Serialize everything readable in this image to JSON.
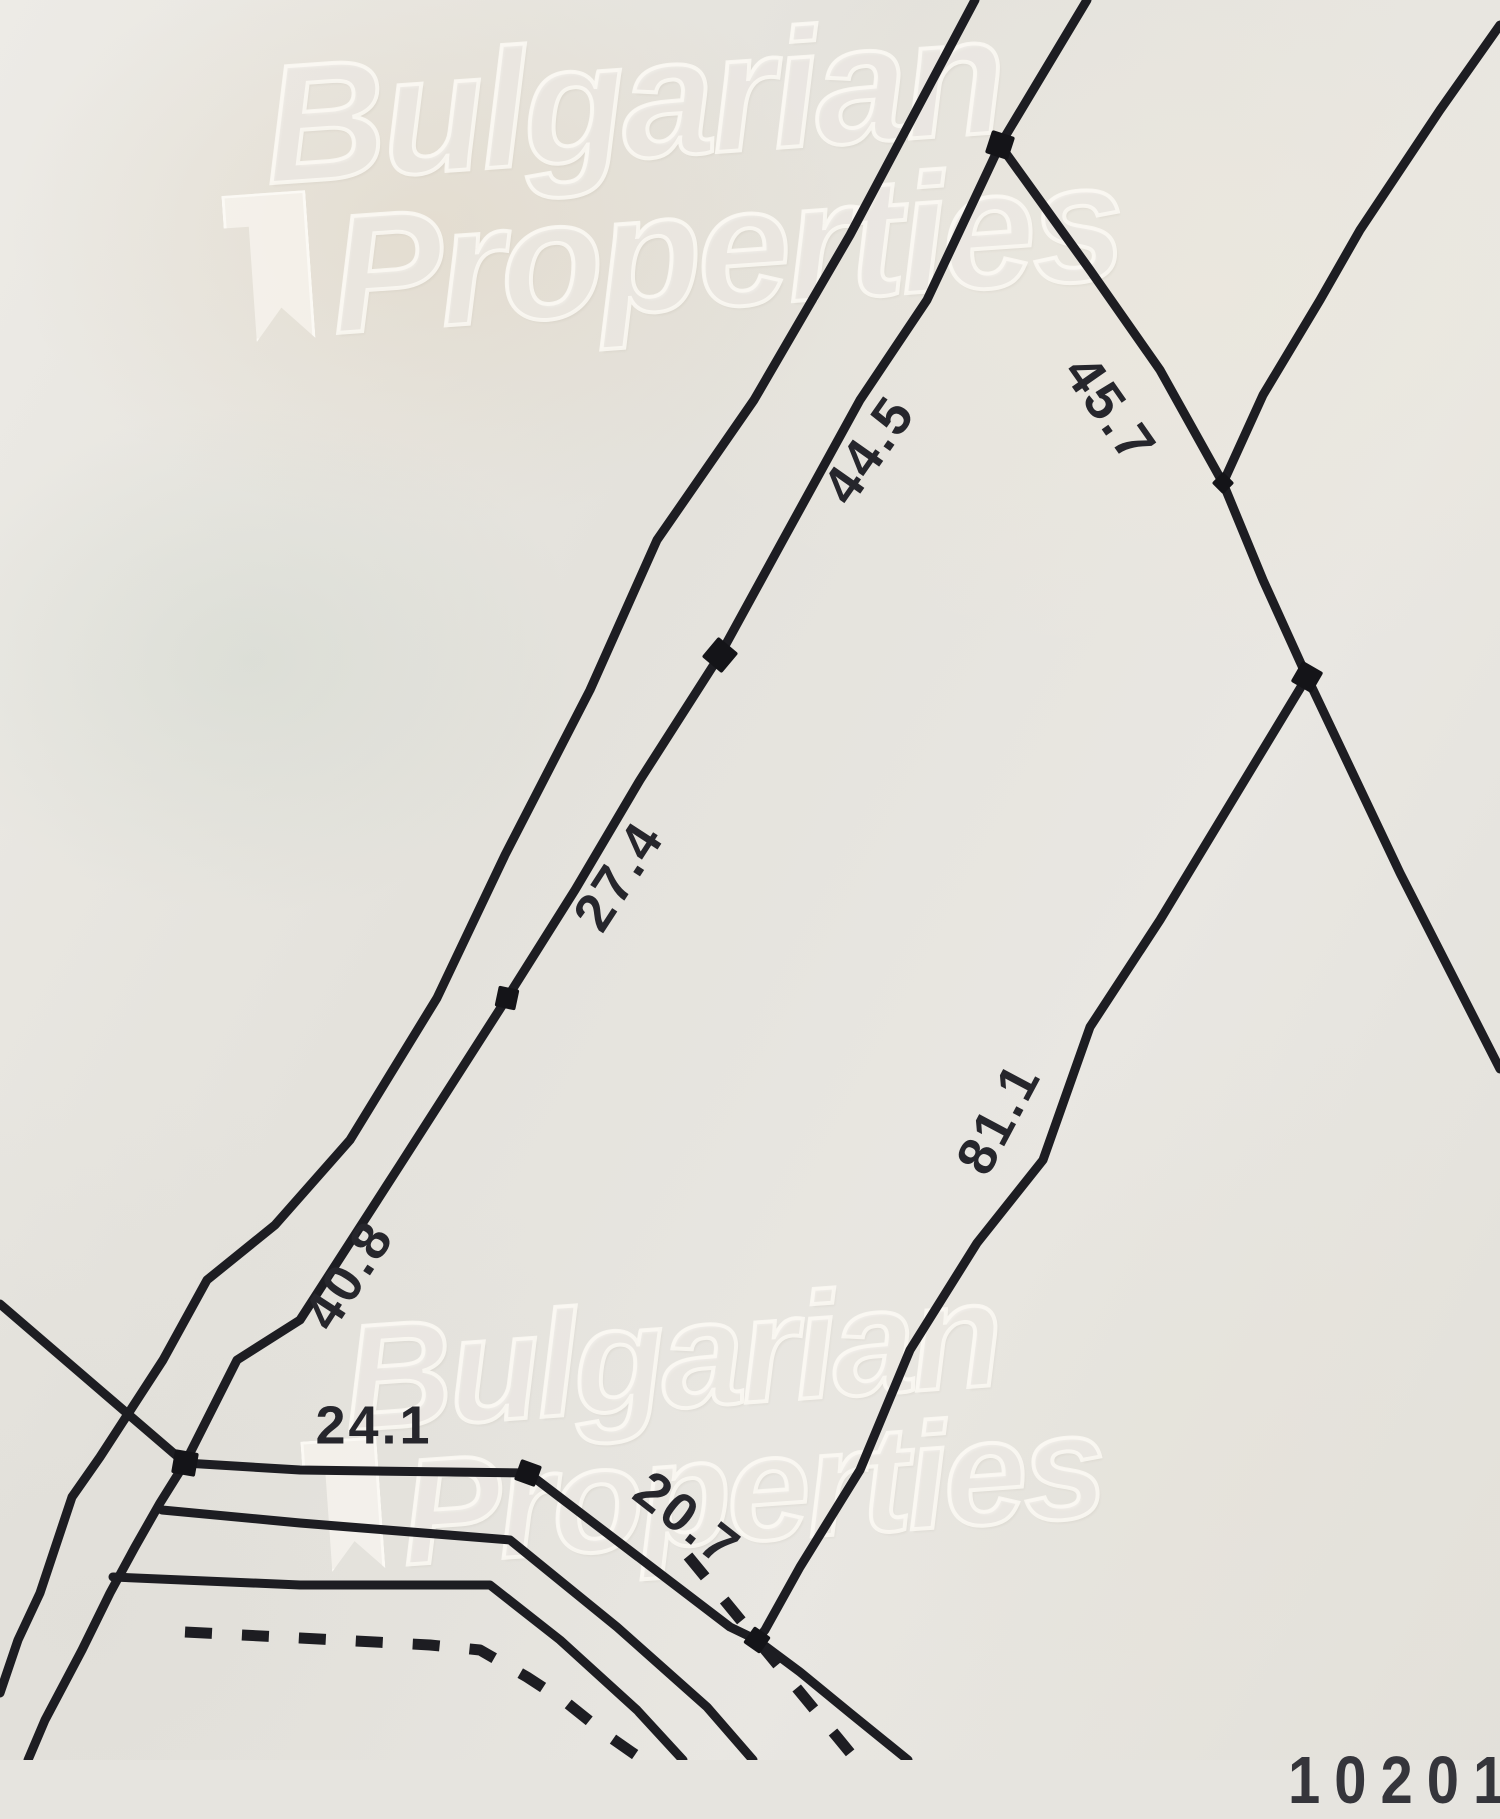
{
  "watermark": {
    "line1": "Bulgarian",
    "line2": "Properties"
  },
  "plan_number": "102015",
  "colors": {
    "paper": "#e6e4df",
    "line": "#1d1d22",
    "label": "#26262c",
    "node": "#141418",
    "watermark_stroke": "rgba(250,248,242,0.88)"
  },
  "drawing": {
    "width": 1500,
    "height": 1760,
    "stroke_width": 9,
    "dash_pattern": "27 30",
    "label_font_size": 54,
    "labels": [
      {
        "name": "dimension-44-5",
        "text": "44.5",
        "x": 872,
        "y": 452,
        "rot": -55
      },
      {
        "name": "dimension-45-7",
        "text": "45.7",
        "x": 1107,
        "y": 412,
        "rot": 55
      },
      {
        "name": "dimension-27-4",
        "text": "27.4",
        "x": 622,
        "y": 878,
        "rot": -57
      },
      {
        "name": "dimension-40-8",
        "text": "40.8",
        "x": 352,
        "y": 1277,
        "rot": -57
      },
      {
        "name": "dimension-81-1",
        "text": "81.1",
        "x": 1002,
        "y": 1120,
        "rot": -62
      },
      {
        "name": "dimension-24-1",
        "text": "24.1",
        "x": 374,
        "y": 1429,
        "rot": 0
      },
      {
        "name": "dimension-20-7",
        "text": "20.7",
        "x": 685,
        "y": 1522,
        "rot": 38
      }
    ],
    "polylines": [
      {
        "name": "left-road-boundary",
        "points": [
          [
            975,
            0
          ],
          [
            850,
            235
          ],
          [
            754,
            400
          ],
          [
            657,
            540
          ],
          [
            590,
            690
          ],
          [
            505,
            855
          ],
          [
            437,
            998
          ],
          [
            350,
            1140
          ],
          [
            275,
            1225
          ],
          [
            207,
            1280
          ],
          [
            163,
            1360
          ],
          [
            100,
            1457
          ],
          [
            72,
            1497
          ],
          [
            40,
            1593
          ],
          [
            18,
            1640
          ],
          [
            0,
            1693
          ]
        ]
      },
      {
        "name": "main-parcel-boundary",
        "points": [
          [
            1087,
            0
          ],
          [
            1000,
            145
          ],
          [
            927,
            300
          ],
          [
            860,
            400
          ],
          [
            783,
            540
          ],
          [
            720,
            655
          ],
          [
            640,
            780
          ],
          [
            575,
            890
          ],
          [
            507,
            998
          ],
          [
            400,
            1165
          ],
          [
            300,
            1320
          ],
          [
            237,
            1360
          ],
          [
            185,
            1463
          ],
          [
            160,
            1503
          ],
          [
            135,
            1547
          ],
          [
            110,
            1593
          ],
          [
            82,
            1650
          ],
          [
            45,
            1720
          ],
          [
            28,
            1760
          ]
        ]
      },
      {
        "name": "segment-45-7",
        "points": [
          [
            1000,
            145
          ],
          [
            1090,
            270
          ],
          [
            1160,
            370
          ],
          [
            1223,
            483
          ]
        ]
      },
      {
        "name": "top-right-boundary",
        "points": [
          [
            1500,
            25
          ],
          [
            1440,
            110
          ],
          [
            1360,
            230
          ],
          [
            1320,
            300
          ],
          [
            1263,
            395
          ],
          [
            1223,
            483
          ]
        ]
      },
      {
        "name": "segment-c-to-b",
        "points": [
          [
            1223,
            483
          ],
          [
            1263,
            580
          ],
          [
            1307,
            677
          ]
        ]
      },
      {
        "name": "east-boundary-continuation",
        "points": [
          [
            1307,
            677
          ],
          [
            1400,
            873
          ],
          [
            1500,
            1069
          ]
        ]
      },
      {
        "name": "segment-81-1",
        "points": [
          [
            1307,
            677
          ],
          [
            1160,
            920
          ],
          [
            1090,
            1027
          ],
          [
            1043,
            1160
          ],
          [
            977,
            1243
          ],
          [
            910,
            1350
          ],
          [
            860,
            1470
          ],
          [
            800,
            1567
          ],
          [
            765,
            1630
          ],
          [
            757,
            1640
          ]
        ]
      },
      {
        "name": "road-line-1",
        "points": [
          [
            0,
            1304
          ],
          [
            100,
            1390
          ],
          [
            185,
            1463
          ],
          [
            300,
            1470
          ],
          [
            528,
            1473
          ],
          [
            633,
            1553
          ],
          [
            730,
            1627
          ],
          [
            757,
            1640
          ],
          [
            800,
            1672
          ],
          [
            850,
            1713
          ],
          [
            908,
            1760
          ]
        ]
      },
      {
        "name": "road-line-2",
        "points": [
          [
            162,
            1510
          ],
          [
            300,
            1523
          ],
          [
            510,
            1540
          ],
          [
            617,
            1627
          ],
          [
            707,
            1707
          ],
          [
            753,
            1760
          ]
        ]
      },
      {
        "name": "road-line-3",
        "points": [
          [
            113,
            1577
          ],
          [
            300,
            1585
          ],
          [
            490,
            1585
          ],
          [
            560,
            1640
          ],
          [
            637,
            1710
          ],
          [
            683,
            1760
          ]
        ]
      }
    ],
    "dashed_polylines": [
      {
        "name": "dashed-line-west",
        "points": [
          [
            185,
            1632
          ],
          [
            300,
            1638
          ],
          [
            430,
            1645
          ],
          [
            480,
            1650
          ],
          [
            527,
            1677
          ],
          [
            567,
            1703
          ],
          [
            607,
            1735
          ],
          [
            643,
            1760
          ]
        ]
      },
      {
        "name": "dashed-line-east",
        "points": [
          [
            688,
            1556
          ],
          [
            757,
            1640
          ],
          [
            838,
            1738
          ],
          [
            856,
            1760
          ]
        ]
      }
    ],
    "nodes": [
      {
        "name": "survey-point-a",
        "x": 1000,
        "y": 145,
        "s": 24,
        "rot": 18
      },
      {
        "name": "survey-point-44-27",
        "x": 720,
        "y": 655,
        "s": 26,
        "rot": 40
      },
      {
        "name": "survey-point-27-40",
        "x": 507,
        "y": 998,
        "s": 21,
        "rot": 12
      },
      {
        "name": "survey-point-c",
        "x": 1223,
        "y": 483,
        "s": 16,
        "rot": 45
      },
      {
        "name": "survey-point-b",
        "x": 1307,
        "y": 677,
        "s": 24,
        "rot": 30
      },
      {
        "name": "survey-point-d",
        "x": 185,
        "y": 1463,
        "s": 24,
        "rot": 10
      },
      {
        "name": "survey-point-road-corner",
        "x": 528,
        "y": 1473,
        "s": 22,
        "rot": 20
      },
      {
        "name": "survey-point-v",
        "x": 757,
        "y": 1640,
        "s": 20,
        "rot": 35
      }
    ]
  }
}
